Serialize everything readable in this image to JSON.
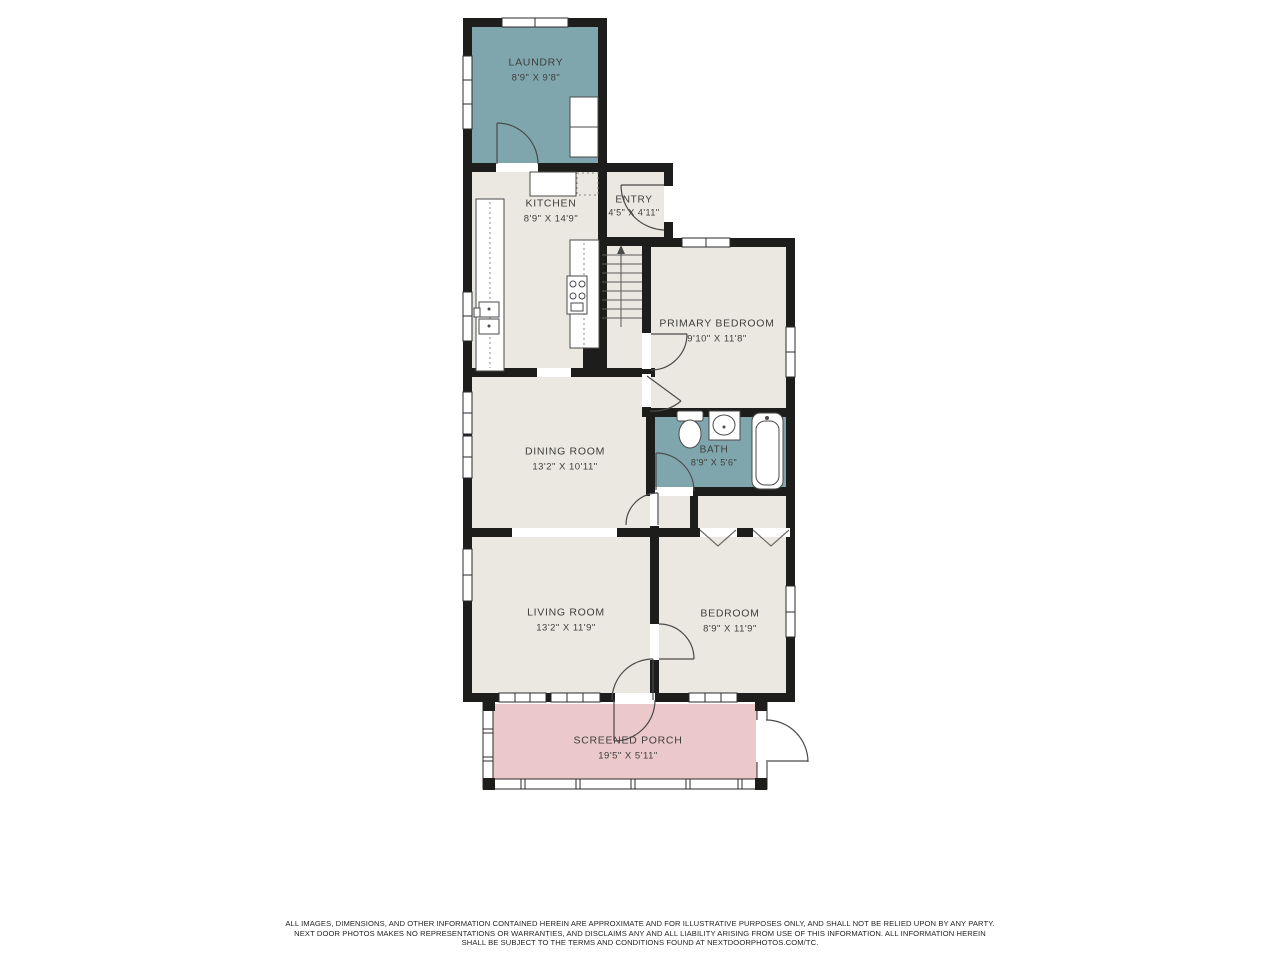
{
  "document": {
    "type": "residential-floor-plan",
    "provider_reference": "NEXTDOORPHOTOS.COM/TC"
  },
  "colors": {
    "page_background": "#ffffff",
    "wall": "#1d1d1b",
    "floor": "#eae8e0",
    "wet_room": "#7fa6ad",
    "porch": "#ebc8ca",
    "label_text": "#3e3e3c"
  },
  "rooms": {
    "laundry": {
      "label": "LAUNDRY",
      "dims": "8'9\" X 9'8\""
    },
    "kitchen": {
      "label": "KITCHEN",
      "dims": "8'9\" X 14'9\""
    },
    "entry": {
      "label": "ENTRY",
      "dims": "4'5\" X 4'11\""
    },
    "primary_bedroom": {
      "label": "PRIMARY BEDROOM",
      "dims": "9'10\" X 11'8\""
    },
    "bath": {
      "label": "BATH",
      "dims": "8'9\" X 5'6\""
    },
    "dining": {
      "label": "DINING ROOM",
      "dims": "13'2\" X 10'11\""
    },
    "living": {
      "label": "LIVING ROOM",
      "dims": "13'2\" X 11'9\""
    },
    "bedroom": {
      "label": "BEDROOM",
      "dims": "8'9\" X 11'9\""
    },
    "porch": {
      "label": "SCREENED PORCH",
      "dims": "19'5\" X 5'11\""
    }
  },
  "footer": {
    "line1": "ALL IMAGES, DIMENSIONS, AND OTHER INFORMATION CONTAINED HEREIN ARE APPROXIMATE AND FOR ILLUSTRATIVE PURPOSES ONLY, AND SHALL NOT BE RELIED UPON BY ANY PARTY.",
    "line2": "NEXT DOOR PHOTOS MAKES NO REPRESENTATIONS OR WARRANTIES, AND DISCLAIMS ANY AND ALL LIABILITY ARISING FROM USE OF THIS INFORMATION. ALL INFORMATION HEREIN",
    "line3": "SHALL BE SUBJECT TO THE TERMS AND CONDITIONS FOUND AT NEXTDOORPHOTOS.COM/TC."
  }
}
